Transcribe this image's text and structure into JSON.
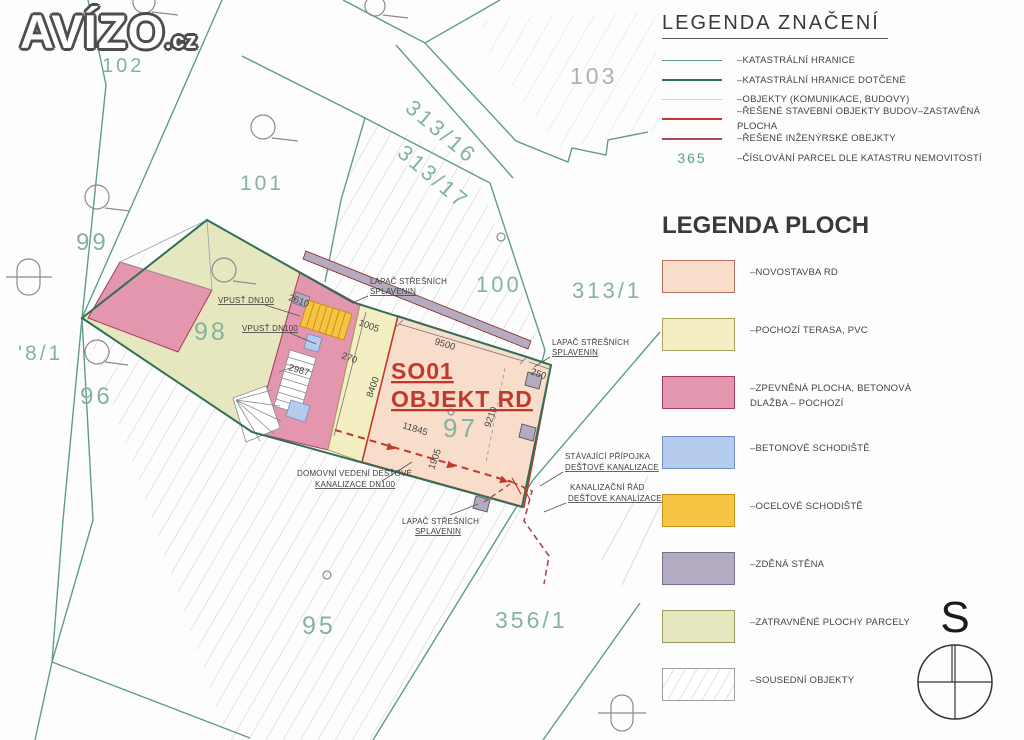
{
  "logo": {
    "main": "AVÍZO",
    "tld": ".cz"
  },
  "north": {
    "label": "S"
  },
  "legend_symbols": {
    "title": "LEGENDA ZNAČENÍ",
    "items": [
      {
        "label": "–KATASTRÁLNÍ HRANICE",
        "color": "#5f9e85",
        "weight": "1.5px"
      },
      {
        "label": "–KATASTRÁLNÍ HRANICE DOTČENÉ",
        "color": "#2f7057",
        "weight": "2.5px"
      },
      {
        "label": "–OBJEKTY (KOMUNIKACE, BUDOVY)",
        "color": "#ccd2d8",
        "weight": "1.5px"
      },
      {
        "label": "–ŘEŠENÉ STAVEBNÍ OBJEKTY BUDOV–ZASTAVĚNÁ PLOCHA",
        "color": "#c5352f",
        "weight": "2.5px"
      },
      {
        "label": "–ŘEŠENÉ INŽENÝRSKÉ OBEJKTY",
        "color": "#a84a52",
        "weight": "2px"
      },
      {
        "number": "365",
        "label": "–ČÍSLOVÁNÍ PARCEL DLE KATASTRU NEMOVITOSTÍ",
        "color": "#55a287"
      }
    ]
  },
  "legend_areas": {
    "title": "LEGENDA PLOCH",
    "items": [
      {
        "label": "–NOVOSTAVBA RD",
        "fill": "#f7ddca",
        "border": "#b5735b"
      },
      {
        "label": "–POCHOZÍ TERASA, PVC",
        "fill": "#f4efc3",
        "border": "#a8a15e"
      },
      {
        "label_line1": "–ZPEVNĚNÁ PLOCHA, BETONOVÁ",
        "label_line2": "DLAŽBA – POCHOZÍ",
        "fill": "#e396ad",
        "border": "#a63d5c"
      },
      {
        "label": "–BETONOVÉ SCHODIŠTĚ",
        "fill": "#b6ccee",
        "border": "#7291c7"
      },
      {
        "label": "–OCELOVÉ SCHODIŠTĚ",
        "fill": "#f6c342",
        "border": "#c9901d"
      },
      {
        "label": "–ZDĚNÁ STĚNA",
        "fill": "#b3abc0",
        "border": "#766f87"
      },
      {
        "label": "–ZATRAVNĚNÉ PLOCHY PARCELY",
        "fill": "#e6e6bf",
        "border": "#9a9a60"
      },
      {
        "label": "–SOUSEDNÍ OBJEKTY",
        "fill": "#ffffff",
        "border": "#9aa0a6"
      }
    ]
  },
  "plan": {
    "parcel_color": "#85b3a0",
    "parcel_color_alt": "#a9b3ac",
    "building": {
      "line1": "SO01",
      "line2": "OBJEKT RD",
      "color": "#c0392b"
    },
    "parcels": {
      "p102": "102",
      "p101": "101",
      "p103": "103",
      "p313_16": "313/16",
      "p313_17": "313/17",
      "p99": "99",
      "p98": "98",
      "p8_1": "'8/1",
      "p96": "96",
      "p100": "100",
      "p313_1": "313/1",
      "p97": "97",
      "p95": "95",
      "p356_1": "356/1"
    },
    "dims": {
      "d2610": "2610",
      "d1005": "1005",
      "d270": "270",
      "d2987": "2987",
      "d9500": "9500",
      "d8400": "8400",
      "d11845": "11845",
      "d9210": "9210",
      "d1905": "1905",
      "d250": "250"
    },
    "ann": {
      "vpust1": "VPUSŤ DN100",
      "vpust2": "VPUSŤ DN100",
      "lapac1a": "LAPAČ STŘEŠNÍCH",
      "lapac1b": "SPLAVENIN",
      "lapac2a": "LAPAČ STŘEŠNÍCH",
      "lapac2b": "SPLAVENIN",
      "lapac3a": "LAPAČ STŘEŠNÍCH",
      "lapac3b": "SPLAVENIN",
      "stav1": "STÁVAJÍCÍ PŘÍPOJKA",
      "stav2": "DEŠŤOVÉ KANALIZACE",
      "kan1": "KANALIZAČNÍ ŘÁD",
      "kan2": "DEŠŤOVÉ KANALIZACE",
      "dom1": "DOMOVNÍ VEDENÍ DEŠŤOVÉ",
      "dom2": "KANALIZACE DN100"
    }
  }
}
